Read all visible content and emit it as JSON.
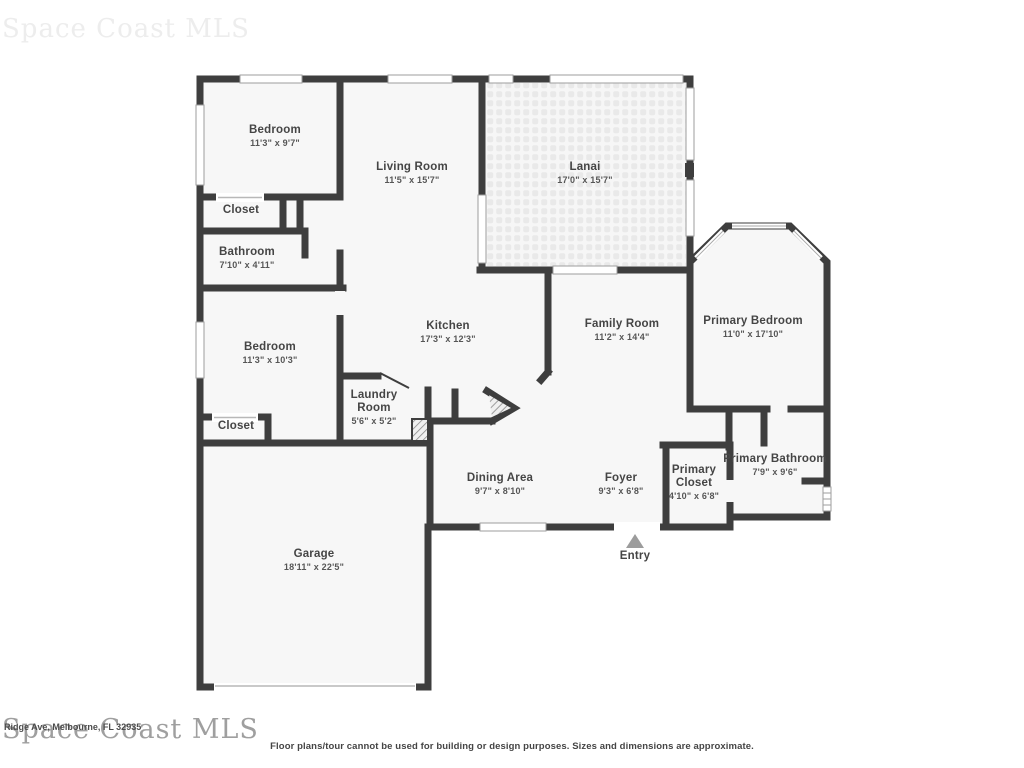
{
  "watermarks": {
    "top": "Space Coast MLS",
    "bottom": "Space Coast MLS",
    "address": "Ridge Ave, Melbourne, FL 32935"
  },
  "disclaimer": "Floor plans/tour cannot be used for building or design purposes. Sizes and dimensions are approximate.",
  "entry": {
    "label": "Entry"
  },
  "colors": {
    "wall": "#3e3e3e",
    "floor": "#f7f7f7",
    "lanai_tile": "#e9e9e9",
    "window_outline": "#9e9e9e",
    "entry_arrow": "#9c9c9c",
    "label_text": "#454545"
  },
  "rooms": [
    {
      "name": "Bedroom",
      "dims": "11'3\" x 9'7\""
    },
    {
      "name": "Living Room",
      "dims": "11'5\" x 15'7\""
    },
    {
      "name": "Lanai",
      "dims": "17'0\" x 15'7\""
    },
    {
      "name": "Closet",
      "dims": ""
    },
    {
      "name": "Bathroom",
      "dims": "7'10\" x 4'11\""
    },
    {
      "name": "Bedroom",
      "dims": "11'3\" x 10'3\""
    },
    {
      "name": "Kitchen",
      "dims": "17'3\" x 12'3\""
    },
    {
      "name": "Family Room",
      "dims": "11'2\" x 14'4\""
    },
    {
      "name": "Primary Bedroom",
      "dims": "11'0\" x 17'10\""
    },
    {
      "name": "Laundry Room",
      "dims": "5'6\" x 5'2\""
    },
    {
      "name": "Closet",
      "dims": ""
    },
    {
      "name": "Dining Area",
      "dims": "9'7\" x 8'10\""
    },
    {
      "name": "Foyer",
      "dims": "9'3\" x 6'8\""
    },
    {
      "name": "Primary Closet",
      "dims": "4'10\" x 6'8\""
    },
    {
      "name": "Primary Bathroom",
      "dims": "7'9\" x 9'6\""
    },
    {
      "name": "Garage",
      "dims": "18'11\" x 22'5\""
    }
  ]
}
